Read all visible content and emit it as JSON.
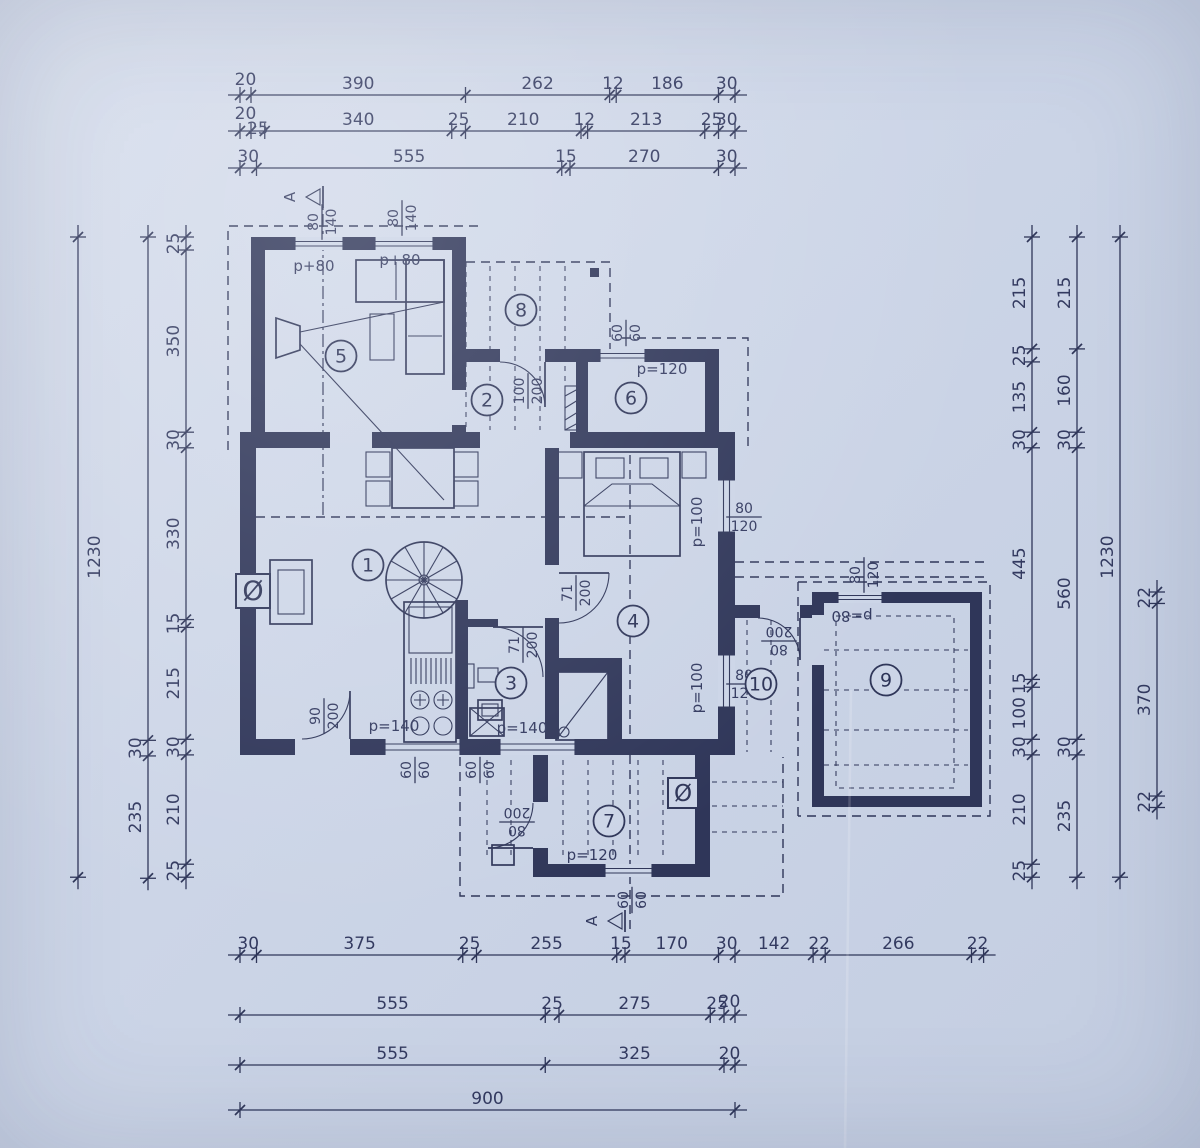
{
  "meta": {
    "background": "#ccd5e7",
    "ink": "#2f3659",
    "drawing_type": "floor-plan"
  },
  "dim_chains": [
    {
      "id": "top-row-1",
      "dir": "h",
      "y": 95,
      "from": 240,
      "vals": [
        20,
        390,
        262,
        12,
        186,
        30
      ],
      "labels": [
        "20",
        "390",
        "262",
        "12",
        "186",
        "30"
      ],
      "label_dy": {
        "0": -4
      }
    },
    {
      "id": "top-row-2",
      "dir": "h",
      "y": 131,
      "from": 240,
      "vals": [
        20,
        25,
        340,
        25,
        210,
        12,
        213,
        25,
        30
      ],
      "labels": [
        "20",
        "25",
        "340",
        "25",
        "210",
        "12",
        "213",
        "25",
        "30"
      ],
      "label_dy": {
        "0": -6,
        "1": 9
      }
    },
    {
      "id": "top-row-3",
      "dir": "h",
      "y": 168,
      "from": 240,
      "vals": [
        30,
        555,
        15,
        270,
        30
      ],
      "labels": [
        "30",
        "555",
        "15",
        "270",
        "30"
      ]
    },
    {
      "id": "bottom-row-1",
      "dir": "h",
      "y": 955,
      "from": 240,
      "vals": [
        30,
        375,
        25,
        255,
        15,
        170,
        30,
        142,
        22,
        266,
        22
      ],
      "labels": [
        "30",
        "375",
        "25",
        "255",
        "15",
        "170",
        "30",
        "142",
        "22",
        "266",
        "22"
      ]
    },
    {
      "id": "bottom-row-2",
      "dir": "h",
      "y": 1015,
      "from": 240,
      "vals": [
        555,
        25,
        275,
        25,
        20
      ],
      "labels": [
        "555",
        "25",
        "275",
        "25",
        "20"
      ],
      "label_dy": {
        "4": -2
      }
    },
    {
      "id": "bottom-row-3",
      "dir": "h",
      "y": 1065,
      "from": 240,
      "vals": [
        555,
        325,
        20
      ],
      "labels": [
        "555",
        "325",
        "20"
      ]
    },
    {
      "id": "bottom-row-4",
      "dir": "h",
      "y": 1110,
      "from": 240,
      "vals": [
        900
      ],
      "labels": [
        "900"
      ]
    },
    {
      "id": "left-outer",
      "dir": "v",
      "x": 78,
      "from": 237,
      "vals": [
        1230
      ],
      "labels": [
        "1230"
      ],
      "label_dx": 22
    },
    {
      "id": "left-middle",
      "dir": "v",
      "x": 148,
      "from": 237,
      "vals": [
        967,
        30,
        235
      ],
      "labels": [
        "",
        "30",
        "235"
      ]
    },
    {
      "id": "left-inner",
      "dir": "v",
      "x": 186,
      "from": 237,
      "vals": [
        25,
        350,
        30,
        330,
        15,
        215,
        30,
        210,
        25
      ],
      "labels": [
        "25",
        "350",
        "30",
        "330",
        "15",
        "215",
        "30",
        "210",
        "25"
      ]
    },
    {
      "id": "right-inner",
      "dir": "v",
      "x": 1032,
      "from": 237,
      "vals": [
        215,
        25,
        135,
        30,
        445,
        15,
        100,
        30,
        210,
        25
      ],
      "labels": [
        "215",
        "25",
        "135",
        "30",
        "445",
        "15",
        "100",
        "30",
        "210",
        "25"
      ]
    },
    {
      "id": "right-middle",
      "dir": "v",
      "x": 1077,
      "from": 237,
      "vals": [
        215,
        160,
        30,
        560,
        30,
        235
      ],
      "labels": [
        "215",
        "160",
        "30",
        "560",
        "30",
        "235"
      ]
    },
    {
      "id": "right-outer",
      "dir": "v",
      "x": 1120,
      "from": 237,
      "vals": [
        1230
      ],
      "labels": [
        "1230"
      ]
    },
    {
      "id": "garage-right",
      "dir": "v",
      "x": 1157,
      "from": 592,
      "vals": [
        22,
        370,
        22
      ],
      "labels": [
        "22",
        "370",
        "22"
      ]
    }
  ],
  "rooms": [
    {
      "n": "1",
      "x": 368,
      "y": 565
    },
    {
      "n": "2",
      "x": 487,
      "y": 400
    },
    {
      "n": "3",
      "x": 511,
      "y": 683
    },
    {
      "n": "4",
      "x": 633,
      "y": 621
    },
    {
      "n": "5",
      "x": 341,
      "y": 356
    },
    {
      "n": "6",
      "x": 631,
      "y": 398
    },
    {
      "n": "7",
      "x": 609,
      "y": 821
    },
    {
      "n": "8",
      "x": 521,
      "y": 310
    },
    {
      "n": "9",
      "x": 886,
      "y": 680
    },
    {
      "n": "10",
      "x": 761,
      "y": 684
    }
  ],
  "opening_labels": [
    {
      "text": "p+80",
      "x": 314,
      "y": 271,
      "rot": 0
    },
    {
      "text": "p+80",
      "x": 400,
      "y": 265,
      "rot": 0
    },
    {
      "text": "p=120",
      "x": 662,
      "y": 374,
      "rot": 0
    },
    {
      "text": "p=100",
      "x": 702,
      "y": 522,
      "rot": -90
    },
    {
      "text": "p=100",
      "x": 702,
      "y": 688,
      "rot": -90
    },
    {
      "text": "p=140",
      "x": 394,
      "y": 731,
      "rot": 0
    },
    {
      "text": "p=140",
      "x": 522,
      "y": 733,
      "rot": 0
    },
    {
      "text": "p=120",
      "x": 592,
      "y": 860,
      "rot": 0
    },
    {
      "text": "p=80",
      "x": 852,
      "y": 611,
      "rot": 180
    }
  ],
  "fraction_labels": [
    {
      "a": "80",
      "b": "140",
      "x": 321,
      "y": 222,
      "rot": -90
    },
    {
      "a": "80",
      "b": "140",
      "x": 401,
      "y": 218,
      "rot": -90
    },
    {
      "a": "60",
      "b": "60",
      "x": 625,
      "y": 333,
      "rot": -90
    },
    {
      "a": "100",
      "b": "200",
      "x": 527,
      "y": 391,
      "rot": -90
    },
    {
      "a": "71",
      "b": "200",
      "x": 575,
      "y": 593,
      "rot": -90
    },
    {
      "a": "71",
      "b": "200",
      "x": 522,
      "y": 645,
      "rot": -90
    },
    {
      "a": "90",
      "b": "200",
      "x": 323,
      "y": 716,
      "rot": -90
    },
    {
      "a": "60",
      "b": "60",
      "x": 414,
      "y": 770,
      "rot": -90
    },
    {
      "a": "60",
      "b": "60",
      "x": 479,
      "y": 770,
      "rot": -90
    },
    {
      "a": "80",
      "b": "200",
      "x": 517,
      "y": 823,
      "rot": 180
    },
    {
      "a": "60",
      "b": "60",
      "x": 631,
      "y": 900,
      "rot": -90
    },
    {
      "a": "80",
      "b": "200",
      "x": 779,
      "y": 642,
      "rot": 180
    },
    {
      "a": "80",
      "b": "120",
      "x": 863,
      "y": 575,
      "rot": -90
    },
    {
      "a": "80",
      "b": "120",
      "x": 744,
      "y": 516,
      "rot": 0
    },
    {
      "a": "80",
      "b": "120",
      "x": 744,
      "y": 683,
      "rot": 0
    }
  ],
  "symbols": [
    {
      "glyph": "Ø",
      "x": 253,
      "y": 600,
      "size": 27
    },
    {
      "glyph": "Ø",
      "x": 683,
      "y": 801,
      "size": 23
    }
  ],
  "section_markers": [
    {
      "letter": "A",
      "x": 308,
      "y": 197
    },
    {
      "letter": "A",
      "x": 610,
      "y": 921
    }
  ]
}
